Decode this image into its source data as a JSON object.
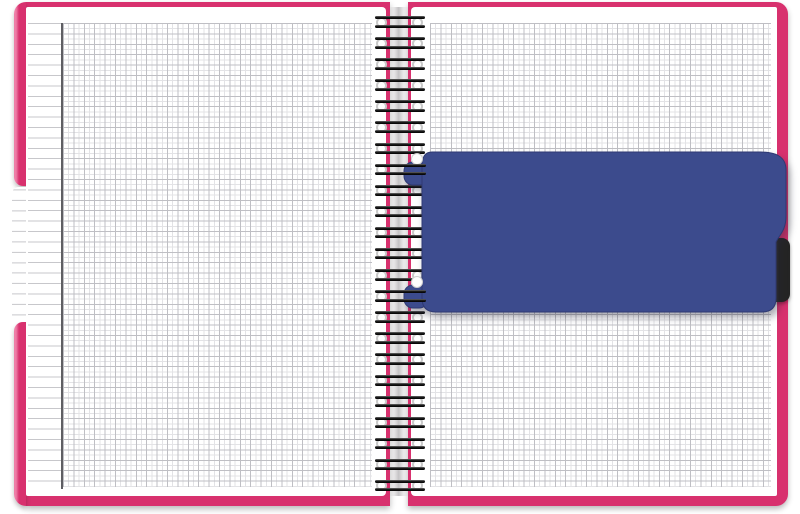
{
  "scene": {
    "type": "product-photo",
    "subject": "Open twin-wire spiral notebook with squared (graph) paper pages, bright pink cover, a navy-blue snap-in divider ruler clipped onto the binding, and a black index tab on the right edge",
    "background": "#ffffff"
  },
  "colors": {
    "cover-pink": "#d8316e",
    "cover-pink-light": "#ee7ea7",
    "page-white": "#ffffff",
    "grid-minor": "#e3e3e6",
    "grid-major": "#bfbfc4",
    "rule-line": "#c7c7cb",
    "margin-line": "#5e5e63",
    "divider-blue": "#3c4b8d",
    "divider-blue-edge": "#2f3a73",
    "tab-black": "#242424",
    "wire-dark": "#181818",
    "eyelet-ring": "#c9c9c9",
    "gutter-shadow": "rgba(60,55,62,0.30)"
  },
  "binding": {
    "style": "twin-wire double-loop",
    "ring_count": 23,
    "hook_ring_indexes": [
      7,
      13
    ]
  },
  "left_page": {
    "paper": "squared grid with ruled left margin column"
  },
  "right_page": {
    "paper": "squared grid"
  },
  "divider": {
    "kind": "snap-in page divider / ruler with two binding hooks",
    "color_name": "navy blue"
  },
  "tabs": {
    "left_cover_notch": "tab cut-out in left cover edge exposing page edge",
    "right_black_tab": "black index tab protruding past right cover edge"
  }
}
